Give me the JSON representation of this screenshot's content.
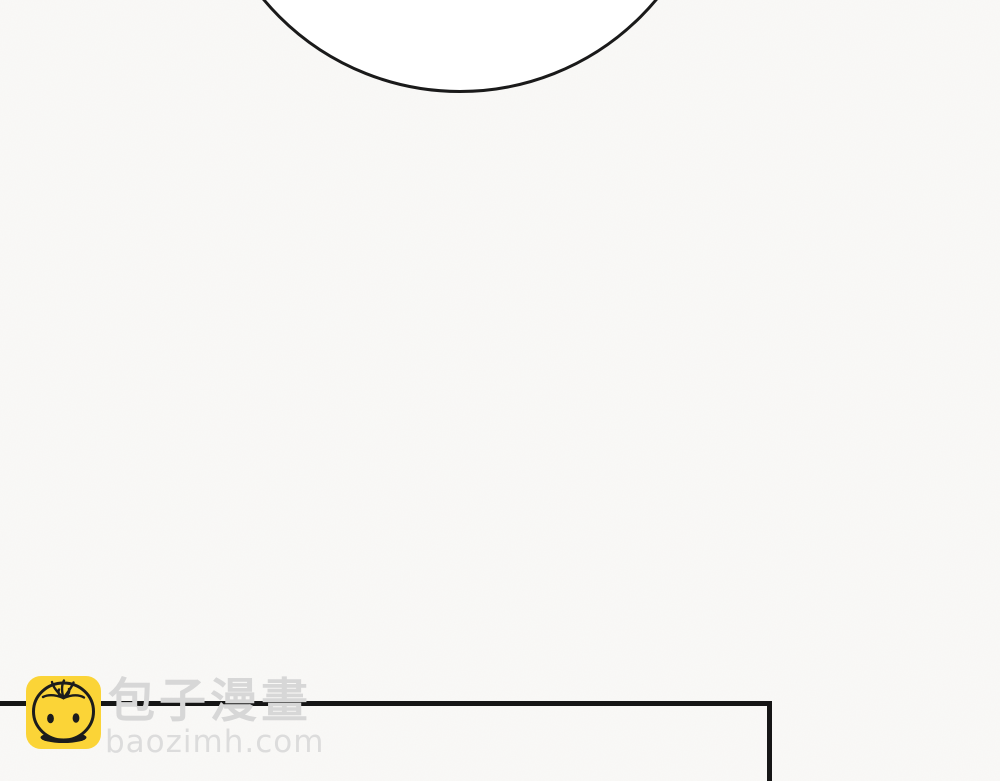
{
  "page": {
    "kind": "comic-page",
    "background_color": "#faf9f7",
    "panel_line_color": "#161616",
    "speech_bubble": {
      "fill": "#ffffff",
      "stroke": "#1a1a1a"
    }
  },
  "watermark": {
    "site_name_cjk": "包子漫畫",
    "site_domain": "baozimh.com",
    "logo_icon": "baozi-bun-face",
    "logo_background_color": "#fbd437",
    "logo_line_color": "#1c1c1c",
    "text_color": "#d7d7d7"
  }
}
